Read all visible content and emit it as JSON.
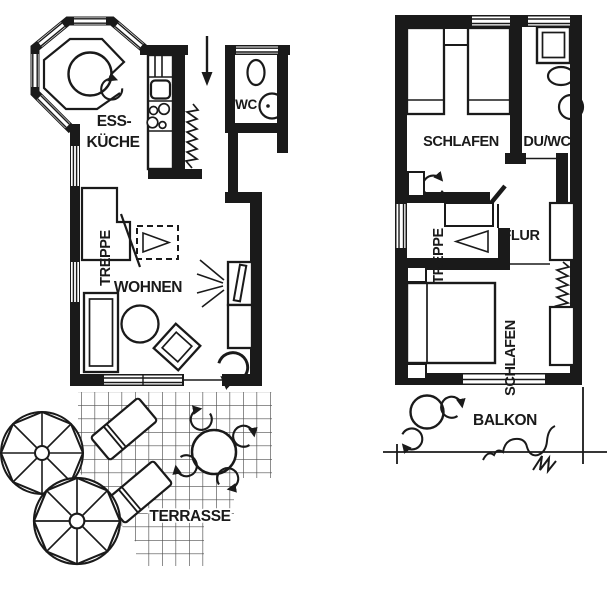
{
  "title": "two-storey holiday house floor plan",
  "colors": {
    "ink": "#1a1a1a",
    "grid": "#4f4f4f",
    "bg": "#ffffff"
  },
  "labels": {
    "eg": {
      "kitchen1": "ESS-",
      "kitchen2": "KÜCHE",
      "wc": "WC",
      "stairs": "TREPPE",
      "living": "WOHNEN",
      "terrace": "TERRASSE"
    },
    "og": {
      "bedroom1": "SCHLAFEN",
      "shower_wc": "DU/WC",
      "stairs": "TREPPE",
      "hall": "FLUR",
      "bedroom2": "SCHLAFEN",
      "balcony": "BALKON"
    }
  }
}
